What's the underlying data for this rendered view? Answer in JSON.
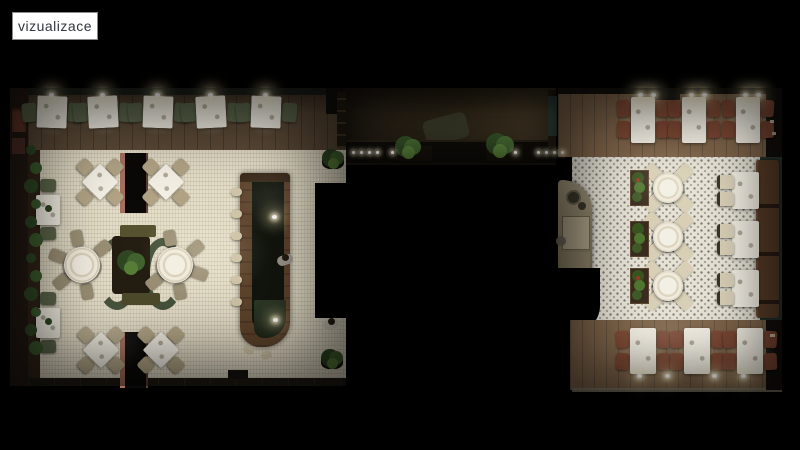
{
  "label": {
    "text": "vizualizace"
  },
  "palette": {
    "background": "#000000",
    "label_bg": "#ffffff",
    "label_text": "#32363c",
    "label_border": "#8a8a8a",
    "wood_left": "#5c4a37",
    "wood_right": "#7d6349",
    "tile_left": "#e4ddc8",
    "tile_right": "#e6e2d6",
    "cloth": "#f3efe4",
    "chair_olive": "#5c664b",
    "chair_tan": "#b1a384",
    "chair_rust": "#7c4733",
    "chair_cream": "#d8cfb6",
    "sofa_brown": "#583d28",
    "wall_teal": "#2e3c34",
    "bar_wood": "#5d432b",
    "bar_top": "#11150d",
    "plant_dark": "#2e4722",
    "plant_light": "#567d38",
    "column_pink": "#a5705f",
    "glow": "#fff6d8"
  },
  "scene": {
    "left_room": {
      "banquette_tables_x": [
        52,
        103,
        158,
        211,
        266
      ],
      "wall_tables": [
        [
          48,
          210
        ],
        [
          48,
          323
        ]
      ],
      "diagonal_tables": [
        [
          100,
          182
        ],
        [
          166,
          182
        ],
        [
          101,
          350
        ],
        [
          161,
          350
        ]
      ],
      "round_tables": [
        {
          "x": 82,
          "y": 265,
          "chair_angles": [
            80,
            140,
            200,
            260,
            320
          ]
        },
        {
          "x": 175,
          "y": 265,
          "chair_angles": [
            260,
            320,
            20,
            80,
            140
          ]
        }
      ],
      "wall_plants_y": [
        150,
        168,
        186,
        204,
        222,
        240,
        258,
        276,
        294,
        312,
        330,
        348
      ],
      "corner_plants": [
        [
          333,
          160
        ],
        [
          332,
          360
        ]
      ],
      "bar_stools_y": [
        188,
        210,
        232,
        254,
        276,
        298
      ],
      "bar_glow": [
        [
          272,
          215
        ],
        [
          273,
          318
        ]
      ],
      "people": [
        [
          285,
          258
        ],
        [
          331,
          322
        ]
      ]
    },
    "corridor": {
      "lights_x": [
        352,
        360,
        368,
        376,
        391,
        514,
        537,
        545,
        553,
        561
      ],
      "lights_y": 151,
      "plants": [
        [
          408,
          149,
          13
        ],
        [
          500,
          147,
          14
        ]
      ]
    },
    "right_room": {
      "top_tables_x": [
        643,
        694,
        748
      ],
      "bottom_tables_x": [
        643,
        697,
        750
      ],
      "round_table_x": 668,
      "round_tables_y": [
        188,
        237,
        286
      ],
      "planters_y": [
        170,
        221,
        268
      ],
      "booth_tables_y": [
        172,
        221,
        270
      ],
      "booth_chairs_y": [
        175,
        192,
        224,
        241,
        273,
        291
      ],
      "top_lights_x": [
        638,
        651,
        689,
        702,
        743,
        756
      ],
      "bottom_lights_x": [
        637,
        665,
        712,
        741
      ]
    }
  }
}
